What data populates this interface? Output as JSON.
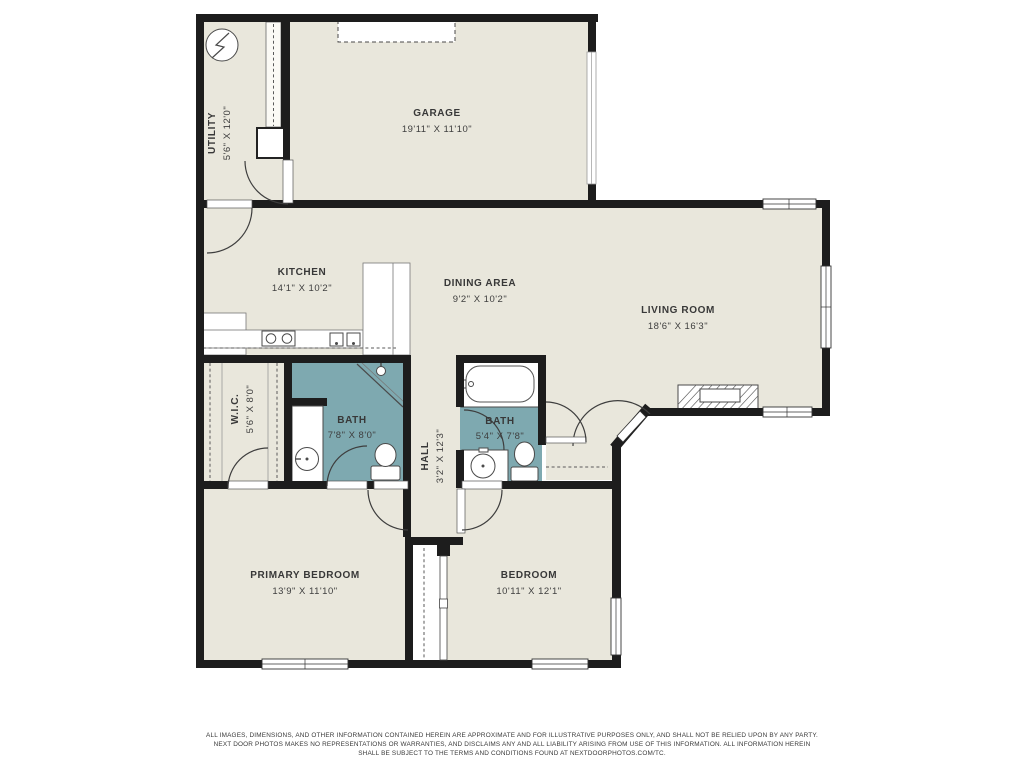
{
  "meta": {
    "type": "residential-floor-plan",
    "provider_mark": "NEXTDOORPHOTOS.COM/TC"
  },
  "colors": {
    "floor": "#e9e7dc",
    "bath_floor": "#7ea9b0",
    "wall": "#1d1d1d",
    "fixture_line": "#4a4a4a",
    "label_text": "#383838",
    "page_bg": "#ffffff"
  },
  "rooms": {
    "utility": {
      "name": "UTILITY",
      "dims": "5'6\" X 12'0\""
    },
    "garage": {
      "name": "GARAGE",
      "dims": "19'11\" X 11'10\""
    },
    "kitchen": {
      "name": "KITCHEN",
      "dims": "14'1\" X 10'2\""
    },
    "dining": {
      "name": "DINING AREA",
      "dims": "9'2\" X 10'2\""
    },
    "living": {
      "name": "LIVING ROOM",
      "dims": "18'6\" X 16'3\""
    },
    "wic": {
      "name": "W.I.C.",
      "dims": "5'6\" X 8'0\""
    },
    "bath1": {
      "name": "BATH",
      "dims": "7'8\" X 8'0\""
    },
    "hall": {
      "name": "HALL",
      "dims": "3'2\" X 12'3\""
    },
    "bath2": {
      "name": "BATH",
      "dims": "5'4\" X 7'8\""
    },
    "primary_bedroom": {
      "name": "PRIMARY BEDROOM",
      "dims": "13'9\" X 11'10\""
    },
    "bedroom": {
      "name": "BEDROOM",
      "dims": "10'11\" X 12'1\""
    }
  },
  "disclaimer": {
    "line1": "ALL IMAGES, DIMENSIONS, AND OTHER INFORMATION CONTAINED HEREIN ARE APPROXIMATE AND FOR ILLUSTRATIVE PURPOSES ONLY, AND SHALL NOT BE RELIED UPON BY ANY PARTY.",
    "line2": "NEXT DOOR PHOTOS MAKES NO REPRESENTATIONS OR WARRANTIES, AND DISCLAIMS ANY AND ALL LIABILITY ARISING FROM USE OF THIS INFORMATION. ALL INFORMATION HEREIN",
    "line3": "SHALL BE SUBJECT TO THE TERMS AND CONDITIONS FOUND AT NEXTDOORPHOTOS.COM/TC."
  }
}
